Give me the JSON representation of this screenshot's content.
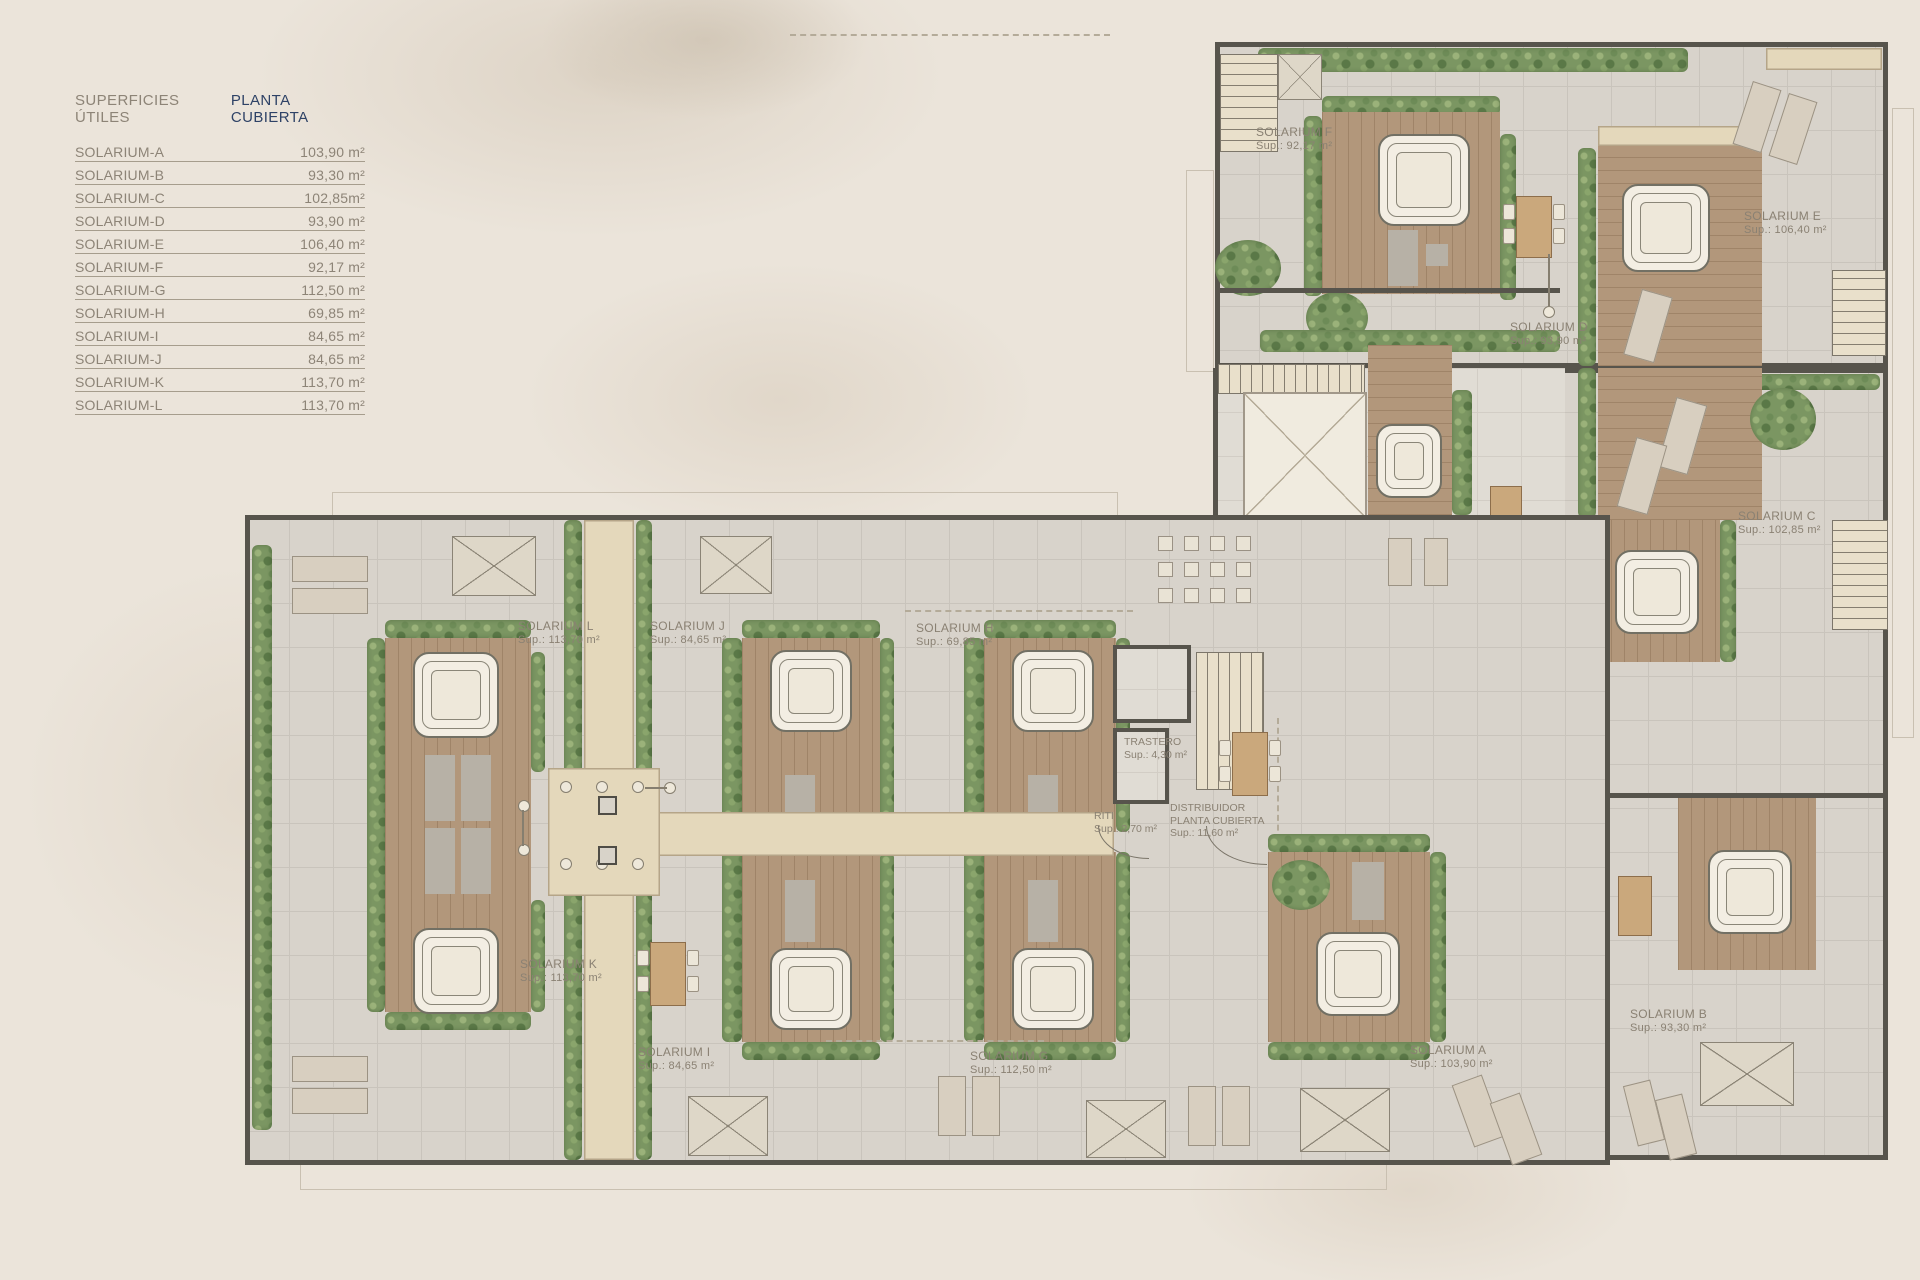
{
  "legend": {
    "title_left": "SUPERFICIES ÚTILES",
    "title_right": "PLANTA CUBIERTA",
    "rows": [
      {
        "label": "SOLARIUM-A",
        "value": "103,90 m²"
      },
      {
        "label": "SOLARIUM-B",
        "value": "93,30 m²"
      },
      {
        "label": "SOLARIUM-C",
        "value": "102,85m²"
      },
      {
        "label": "SOLARIUM-D",
        "value": "93,90 m²"
      },
      {
        "label": "SOLARIUM-E",
        "value": "106,40 m²"
      },
      {
        "label": "SOLARIUM-F",
        "value": "92,17 m²"
      },
      {
        "label": "SOLARIUM-G",
        "value": "112,50 m²"
      },
      {
        "label": "SOLARIUM-H",
        "value": "69,85 m²"
      },
      {
        "label": "SOLARIUM-I",
        "value": "84,65 m²"
      },
      {
        "label": "SOLARIUM-J",
        "value": "84,65 m²"
      },
      {
        "label": "SOLARIUM-K",
        "value": "113,70 m²"
      },
      {
        "label": "SOLARIUM-L",
        "value": "113,70 m²"
      }
    ]
  },
  "plan": {
    "unit_labels": [
      {
        "name": "SOLARIUM F",
        "sup": "Sup.: 92,17 m²"
      },
      {
        "name": "SOLARIUM E",
        "sup": "Sup.: 106,40 m²"
      },
      {
        "name": "SOLARIUM D",
        "sup": "Sup.: 93,90 m²"
      },
      {
        "name": "SOLARIUM C",
        "sup": "Sup.: 102,85 m²"
      },
      {
        "name": "SOLARIUM L",
        "sup": "Sup.: 113,70 m²"
      },
      {
        "name": "SOLARIUM J",
        "sup": "Sup.: 84,65 m²"
      },
      {
        "name": "SOLARIUM H",
        "sup": "Sup.: 69,85 m²"
      },
      {
        "name": "SOLARIUM K",
        "sup": "Sup.: 113,70 m²"
      },
      {
        "name": "SOLARIUM I",
        "sup": "Sup.: 84,65 m²"
      },
      {
        "name": "SOLARIUM G",
        "sup": "Sup.: 112,50 m²"
      },
      {
        "name": "SOLARIUM A",
        "sup": "Sup.: 103,90 m²"
      },
      {
        "name": "SOLARIUM B",
        "sup": "Sup.: 93,30 m²"
      }
    ],
    "rooms": [
      {
        "name": "TRASTERO",
        "sup": "Sup.: 4,30 m²"
      },
      {
        "name": "RITI",
        "sup": "Sup.: 2,70 m²"
      },
      {
        "name": "DISTRIBUIDOR",
        "line2": "PLANTA CUBIERTA",
        "sup": "Sup.: 11,60 m²"
      }
    ]
  },
  "colors": {
    "page_background": "#ebe4da",
    "terrace_tile": "#d8d3cb",
    "wood_deck": "#b2977b",
    "hedge_green": "#7b9662",
    "walkway_beige": "#e4d8bb",
    "wall_dark": "#57544c",
    "label_grey": "#8a8173",
    "legend_accent_navy": "#2e4266"
  }
}
